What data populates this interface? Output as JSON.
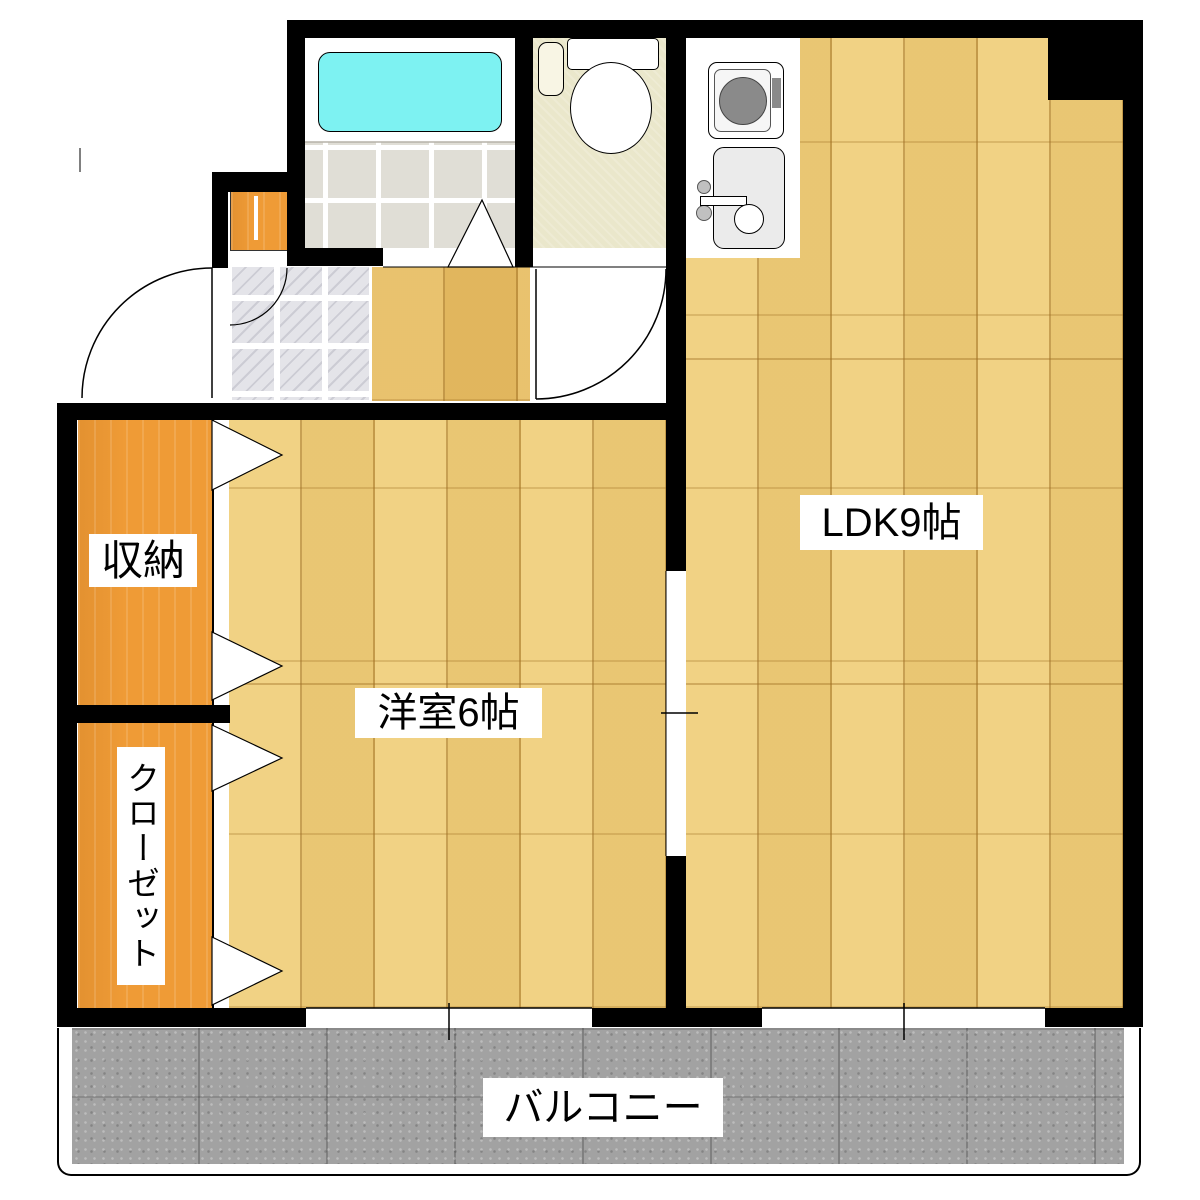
{
  "plan": {
    "type": "apartment-floor-plan",
    "labels": {
      "ldk": "LDK9帖",
      "western_room": "洋室6帖",
      "storage": "収納",
      "closet": "クローゼット",
      "balcony": "バルコニー"
    },
    "fixtures": [
      "bathtub",
      "bathroom-folding-door",
      "toilet",
      "toilet-swing-door",
      "kitchen-stove",
      "kitchen-sink",
      "entrance-swing-door",
      "shoe-cabinet",
      "storage-folding-doors",
      "closet-folding-doors",
      "ldk-opening",
      "balcony-window-west-room",
      "balcony-window-ldk"
    ],
    "colors": {
      "wall": "#000000",
      "ldk_floor": "#f0cf7b",
      "hall_floor": "#e7bd63",
      "orange_floor": "#ef9b36",
      "bathtub": "#7df2f2",
      "toilet_floor": "#eae7cb",
      "bath_tile": "#e0ded6",
      "genkan_tile": "#e4e4e9",
      "balcony_concrete": "#a2a2a2",
      "fixture_gray": "#8a8a8a"
    }
  }
}
